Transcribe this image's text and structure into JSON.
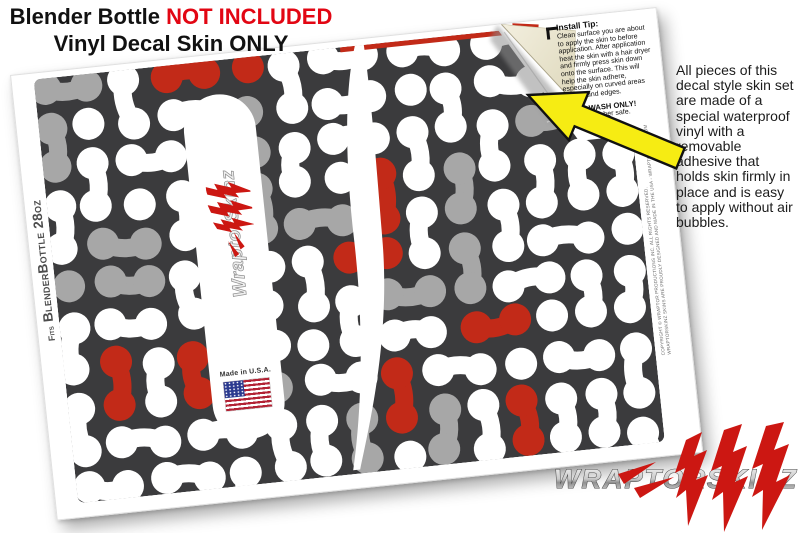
{
  "header": {
    "title_black": "Blender Bottle",
    "title_red": "NOT INCLUDED",
    "subtitle": "Vinyl Decal Skin ONLY"
  },
  "side_note": "All pieces of this decal style  skin set are made of a special waterproof vinyl with a removable adhesive that holds skin firmly in place and is easy to apply without air bubbles.",
  "install_tip": {
    "heading": "Install Tip:",
    "body": "Clean surface you are about to apply the skin to before application. After application heat the skin with a hair dryer and firmly press skin down onto the surface. This will help the skin adhere, especially on curved areas and around edges.",
    "hand_wash": "HAND WASH ONLY!",
    "dishwasher": "Not dishwasher safe."
  },
  "sheet": {
    "fits_prefix": "Fits",
    "fits_label": "BlenderBottle 28oz",
    "made_in_usa": "Made in U.S.A.",
    "fine_print_line1": "COPYRIGHT © WRAPTOR PRODUCTIONS INC. ALL RIGHTS RESERVED.",
    "fine_print_line2": "WRAPTORSKINZ SKINS ARE PROUDLY DESIGNED AND MADE IN THE USA - WRAPTORSKINZ.COM"
  },
  "brand": {
    "logo_text": "WRAPTORSKINZ",
    "strip_logo_text": "WraptorSkinz"
  },
  "colors": {
    "pattern_dark": "#3b3b3d",
    "pattern_red": "#c22a18",
    "pattern_gray": "#a7a7a7",
    "pattern_white": "#ffffff",
    "headline_red": "#e20613",
    "arrow_yellow": "#f6ec13",
    "peel_cream": "#ece7d2",
    "flag_blue": "#2b3a8f",
    "flag_red": "#b22234",
    "claw_red": "#cc1712"
  }
}
